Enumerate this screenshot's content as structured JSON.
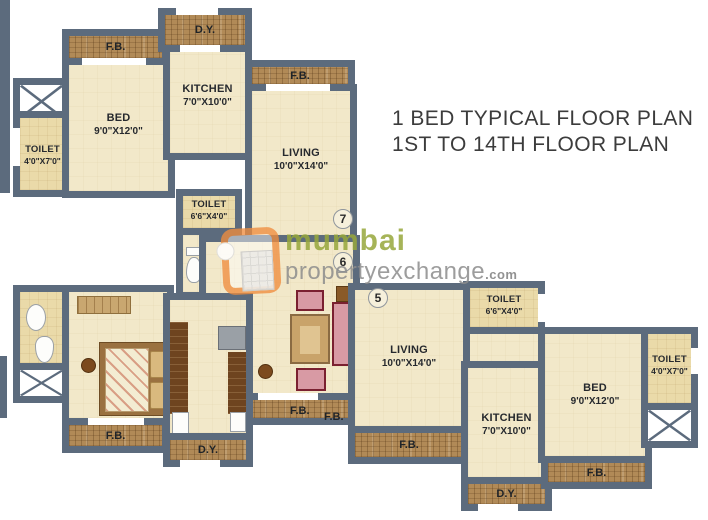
{
  "header": {
    "title_line1": "1 BED TYPICAL FLOOR PLAN",
    "title_line2": "1ST TO 14TH FLOOR PLAN"
  },
  "watermark": {
    "brand_top": "mumbai",
    "brand_bottom": "propertyexchange",
    "brand_tld": ".com"
  },
  "colors": {
    "wall": "#5c6b7d",
    "floor": "#f2e8c9",
    "toilet_floor": "#eadaa9",
    "balcony_wood": "#b18a57",
    "brand_green": "#97a73b",
    "brand_orange": "#ed7d23",
    "title_text": "#3c3c3c"
  },
  "flats": {
    "top": {
      "unit_number": "7",
      "bed": {
        "name": "BED",
        "dims": "9'0\"X12'0\""
      },
      "kitchen": {
        "name": "KITCHEN",
        "dims": "7'0\"X10'0\""
      },
      "living": {
        "name": "LIVING",
        "dims": "10'0\"X14'0\""
      },
      "toilet_left": {
        "name": "TOILET",
        "dims": "4'0\"X7'0\""
      },
      "toilet_mid": {
        "name": "TOILET",
        "dims": "6'6\"X4'0\""
      },
      "fb_bed": "F.B.",
      "dy": "D.Y.",
      "fb_living": "F.B."
    },
    "bottom_left": {
      "unit_number": "6",
      "fb_bed": "F.B.",
      "dy": "D.Y.",
      "fb_living_a": "F.B.",
      "fb_living_b": "F.B."
    },
    "bottom_right": {
      "unit_number": "5",
      "living": {
        "name": "LIVING",
        "dims": "10'0\"X14'0\""
      },
      "toilet_top": {
        "name": "TOILET",
        "dims": "6'6\"X4'0\""
      },
      "toilet_right": {
        "name": "TOILET",
        "dims": "4'0\"X7'0\""
      },
      "bed": {
        "name": "BED",
        "dims": "9'0\"X12'0\""
      },
      "kitchen": {
        "name": "KITCHEN",
        "dims": "7'0\"X10'0\""
      },
      "fb_living": "F.B.",
      "fb_bed": "F.B.",
      "dy": "D.Y."
    }
  }
}
